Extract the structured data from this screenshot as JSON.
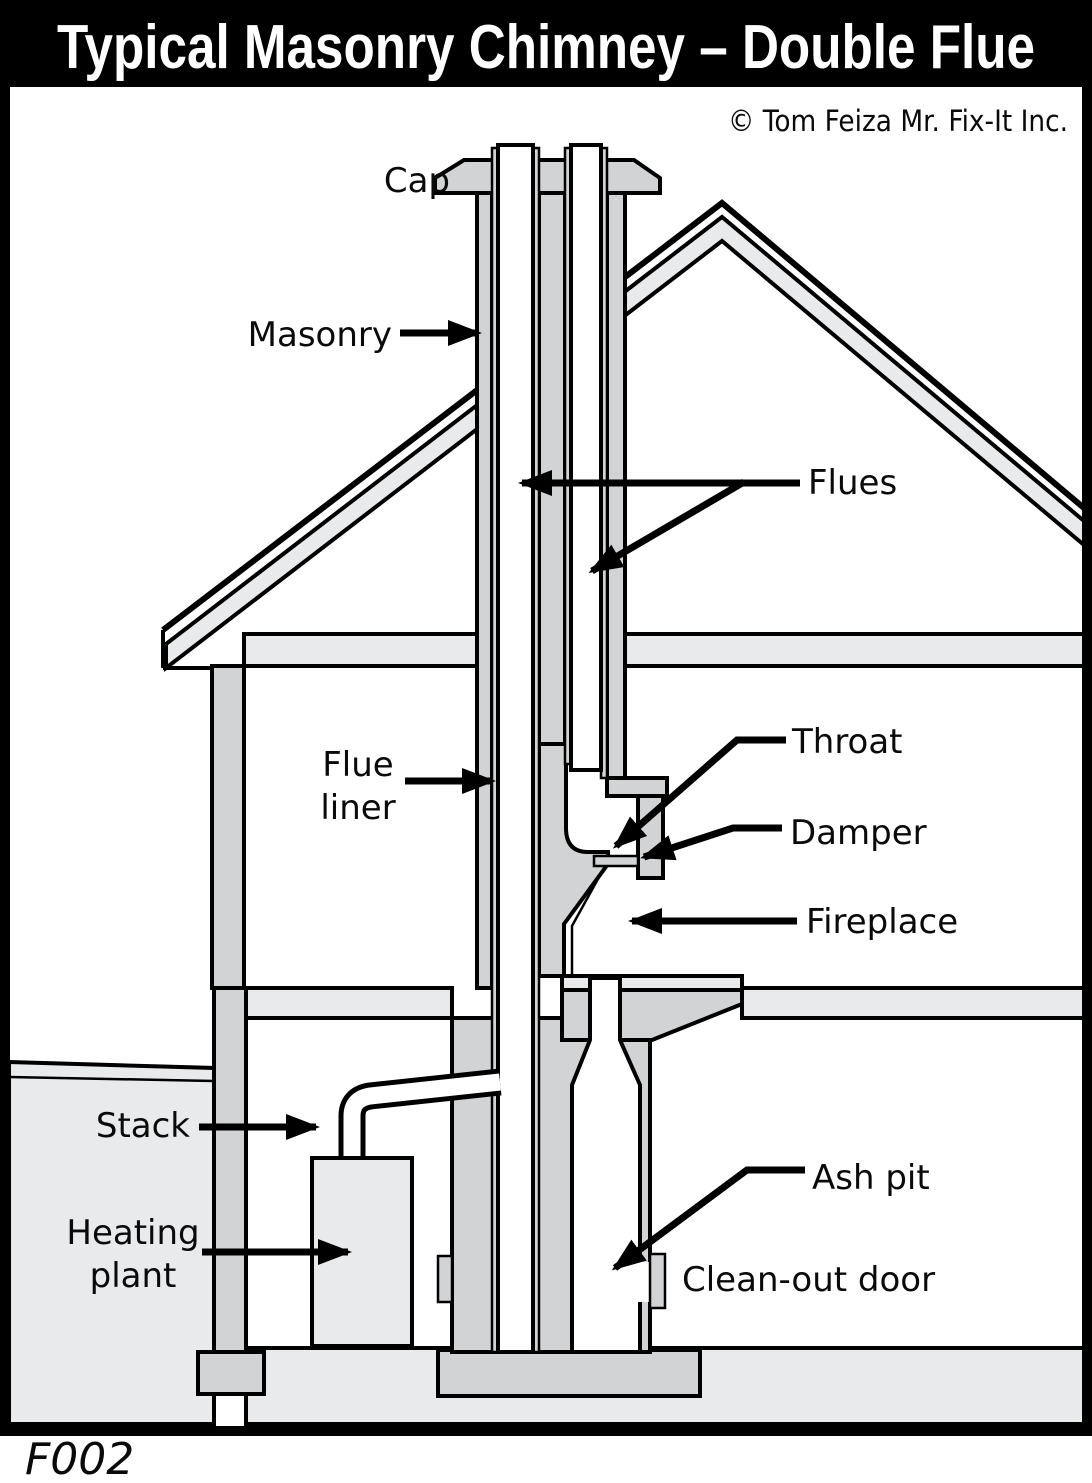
{
  "title": "Typical Masonry Chimney – Double Flue",
  "credit": "© Tom Feiza Mr. Fix-It Inc.",
  "figure_id": "F002",
  "colors": {
    "masonry": "#d1d3d5",
    "light": "#e9eaec",
    "line": "#000000",
    "paper": "#ffffff",
    "titlebg": "#000000",
    "titlefg": "#ffffff"
  },
  "labels": {
    "cap": "Cap",
    "masonry": "Masonry",
    "flues": "Flues",
    "flue_liner_line1": "Flue",
    "flue_liner_line2": "liner",
    "throat": "Throat",
    "damper": "Damper",
    "fireplace": "Fireplace",
    "stack": "Stack",
    "heating_line1": "Heating",
    "heating_line2": "plant",
    "ash_pit": "Ash pit",
    "clean_out_door": "Clean-out door"
  }
}
